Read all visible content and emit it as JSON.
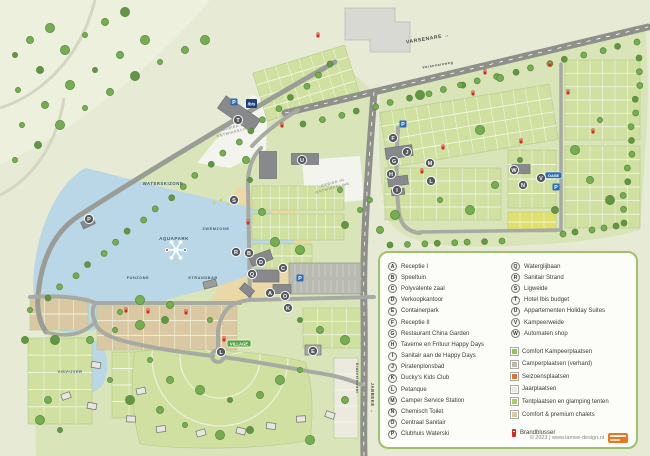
{
  "map": {
    "zone_labels": [
      {
        "text": "WATERSKIZONE",
        "x": 163,
        "y": 185,
        "size": 4.2,
        "rot": 0
      },
      {
        "text": "ZWEMZONE",
        "x": 216,
        "y": 230,
        "size": 3.8,
        "rot": 0
      },
      {
        "text": "AQUAPARK",
        "x": 174,
        "y": 240,
        "size": 4.4,
        "rot": 0
      },
      {
        "text": "FUNZONE",
        "x": 138,
        "y": 279,
        "size": 3.8,
        "rot": 0
      },
      {
        "text": "STRANDBAR",
        "x": 203,
        "y": 279,
        "size": 3.8,
        "rot": 0
      },
      {
        "text": "VISVIJVER",
        "x": 70,
        "y": 373,
        "size": 3.8,
        "rot": 0
      }
    ],
    "road_labels": [
      {
        "text": "VARSENARE →",
        "x": 428,
        "y": 40,
        "size": 5,
        "rot": -9.5
      },
      {
        "text": "Varsenareweg",
        "x": 438,
        "y": 66,
        "size": 3.6,
        "rot": -9.5
      },
      {
        "text": "Krakeelstraat",
        "x": 356,
        "y": 378,
        "size": 3.6,
        "rot": 90
      },
      {
        "text": "JABBEKE →",
        "x": 371,
        "y": 398,
        "size": 4.2,
        "rot": 90
      }
    ],
    "dev_area_label": "GEBIED IN\nONTWIKKELING",
    "dev_areas": [
      {
        "x": 234,
        "y": 128,
        "rot": -15
      },
      {
        "x": 333,
        "y": 184,
        "rot": -15
      }
    ],
    "signs": {
      "village": "VILLAGE",
      "oase": "OASE",
      "ibis": "ibis",
      "parking": "P"
    },
    "markers": [
      {
        "letter": "A",
        "x": 270,
        "y": 293
      },
      {
        "letter": "B",
        "x": 249,
        "y": 253
      },
      {
        "letter": "C",
        "x": 283,
        "y": 268
      },
      {
        "letter": "D",
        "x": 261,
        "y": 262
      },
      {
        "letter": "E",
        "x": 313,
        "y": 351
      },
      {
        "letter": "F",
        "x": 393,
        "y": 138
      },
      {
        "letter": "G",
        "x": 394,
        "y": 161
      },
      {
        "letter": "H",
        "x": 391,
        "y": 174
      },
      {
        "letter": "I",
        "x": 397,
        "y": 190
      },
      {
        "letter": "J",
        "x": 407,
        "y": 152
      },
      {
        "letter": "K",
        "x": 288,
        "y": 308
      },
      {
        "letter": "L",
        "x": 431,
        "y": 181
      },
      {
        "letter": "L",
        "x": 221,
        "y": 352
      },
      {
        "letter": "M",
        "x": 430,
        "y": 163
      },
      {
        "letter": "N",
        "x": 523,
        "y": 185
      },
      {
        "letter": "O",
        "x": 285,
        "y": 296
      },
      {
        "letter": "P",
        "x": 89,
        "y": 219
      },
      {
        "letter": "Q",
        "x": 252,
        "y": 274
      },
      {
        "letter": "R",
        "x": 236,
        "y": 252
      },
      {
        "letter": "S",
        "x": 234,
        "y": 200
      },
      {
        "letter": "T",
        "x": 238,
        "y": 120
      },
      {
        "letter": "U",
        "x": 302,
        "y": 160
      },
      {
        "letter": "V",
        "x": 541,
        "y": 178
      },
      {
        "letter": "W",
        "x": 514,
        "y": 170
      }
    ],
    "parking_icons": [
      {
        "x": 234,
        "y": 102
      },
      {
        "x": 403,
        "y": 124
      },
      {
        "x": 300,
        "y": 278
      },
      {
        "x": 556,
        "y": 187
      }
    ],
    "fire_extinguishers": [
      [
        282,
        125
      ],
      [
        422,
        171
      ],
      [
        443,
        147
      ],
      [
        473,
        93
      ],
      [
        485,
        72
      ],
      [
        550,
        64
      ],
      [
        568,
        92
      ],
      [
        126,
        310
      ],
      [
        148,
        311
      ],
      [
        186,
        312
      ],
      [
        224,
        339
      ],
      [
        248,
        222
      ],
      [
        521,
        141
      ],
      [
        593,
        131
      ],
      [
        318,
        35
      ]
    ]
  },
  "legend": {
    "facilities_col1": [
      {
        "letter": "A",
        "label": "Receptie I"
      },
      {
        "letter": "B",
        "label": "Speeltuin"
      },
      {
        "letter": "C",
        "label": "Polyvalente zaal"
      },
      {
        "letter": "D",
        "label": "Verkoopkantoor"
      },
      {
        "letter": "E",
        "label": "Containerpark"
      },
      {
        "letter": "F",
        "label": "Receptie II"
      },
      {
        "letter": "G",
        "label": "Restaurant China Garden"
      },
      {
        "letter": "H",
        "label": "Taverne en Frituur Happy Days"
      },
      {
        "letter": "I",
        "label": "Sanitair aan de Happy Days"
      },
      {
        "letter": "J",
        "label": "Piratenplonsbad"
      },
      {
        "letter": "K",
        "label": "Ducky's Kids Club"
      },
      {
        "letter": "L",
        "label": "Petanque"
      },
      {
        "letter": "M",
        "label": "Camper Service Station"
      },
      {
        "letter": "N",
        "label": "Chemisch Toilet"
      },
      {
        "letter": "O",
        "label": "Centraal Sanitair"
      },
      {
        "letter": "P",
        "label": "Clubhuis Waterski"
      }
    ],
    "facilities_col2": [
      {
        "letter": "Q",
        "label": "Waterglijbaan"
      },
      {
        "letter": "R",
        "label": "Sanitair Strand"
      },
      {
        "letter": "S",
        "label": "Ligweide"
      },
      {
        "letter": "T",
        "label": "Hotel Ibis budget"
      },
      {
        "letter": "U",
        "label": "Appartementen Holiday Suites"
      },
      {
        "letter": "V",
        "label": "Kampeerweide"
      },
      {
        "letter": "W",
        "label": "Automaten shop"
      }
    ],
    "pitch_types": [
      {
        "label": "Comfort Kampeerplaatsen",
        "color": "#95c05a"
      },
      {
        "label": "Camperplaatsen (verhard)",
        "color": "#b9b9b1"
      },
      {
        "label": "Seizoensplaatsen",
        "color": "#e0703c"
      },
      {
        "label": "Jaarplaatsen",
        "color": "#eae8da"
      },
      {
        "label": "Tentplaatsen en glamping tenten",
        "color": "#a8cf5f"
      },
      {
        "label": "Comfort & premium chalets",
        "color": "#d9c8a2"
      }
    ],
    "fire_label": "Brandblusser",
    "copyright": "© 2023 | www.lamee-design.nl"
  },
  "colors": {
    "water": "#b9d7e6",
    "sand": "#ead9a6",
    "plot_green": "#cfe0a0",
    "chalet_tan": "#d9c8a2",
    "road_gray": "#8e9089",
    "field": "#e7ebd6",
    "park_green": "#d9e5b8",
    "legend_border": "#9cc06b",
    "accent_orange": "#e87722",
    "fire_red": "#d42b1e",
    "sign_blue": "#2a6db5",
    "village_green": "#58a23f",
    "marker_gray": "#55585c"
  }
}
